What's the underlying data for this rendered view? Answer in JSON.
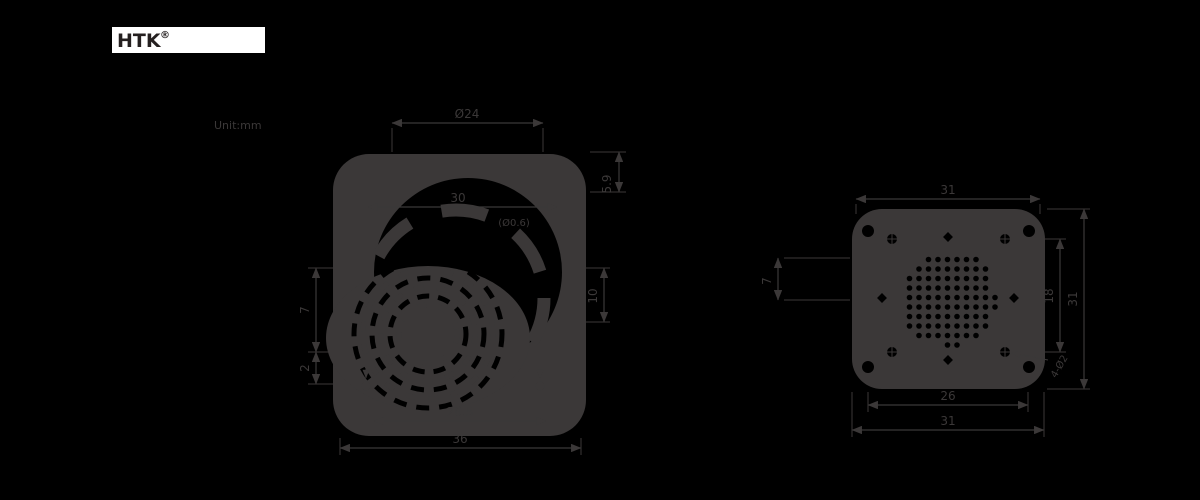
{
  "colors": {
    "background": "#000000",
    "ink": "#3b3838",
    "logo_background": "#ffffff",
    "logo_text_color": "#241f1f"
  },
  "header": {
    "logo_text": "HTK",
    "logo_mark": "®",
    "unit_note": "Unit:mm"
  },
  "front_view": {
    "title": "front-view",
    "dimensions": {
      "top_diameter": "Ø24",
      "inner_width": "30",
      "inner_note": "(Ø0.6)",
      "depth": "5.9",
      "right_spacing": "10",
      "left_upper": "7",
      "left_lower": "2",
      "bottom_inner": "26.5",
      "bottom_outer": "36"
    }
  },
  "rear_view": {
    "title": "rear-view",
    "dimensions": {
      "top_width": "31",
      "bottom_inner": "26",
      "bottom_outer": "31",
      "hole_spacing": "18",
      "right_height": "31",
      "left_height": "7",
      "hole_note": "4-Ø2"
    }
  }
}
